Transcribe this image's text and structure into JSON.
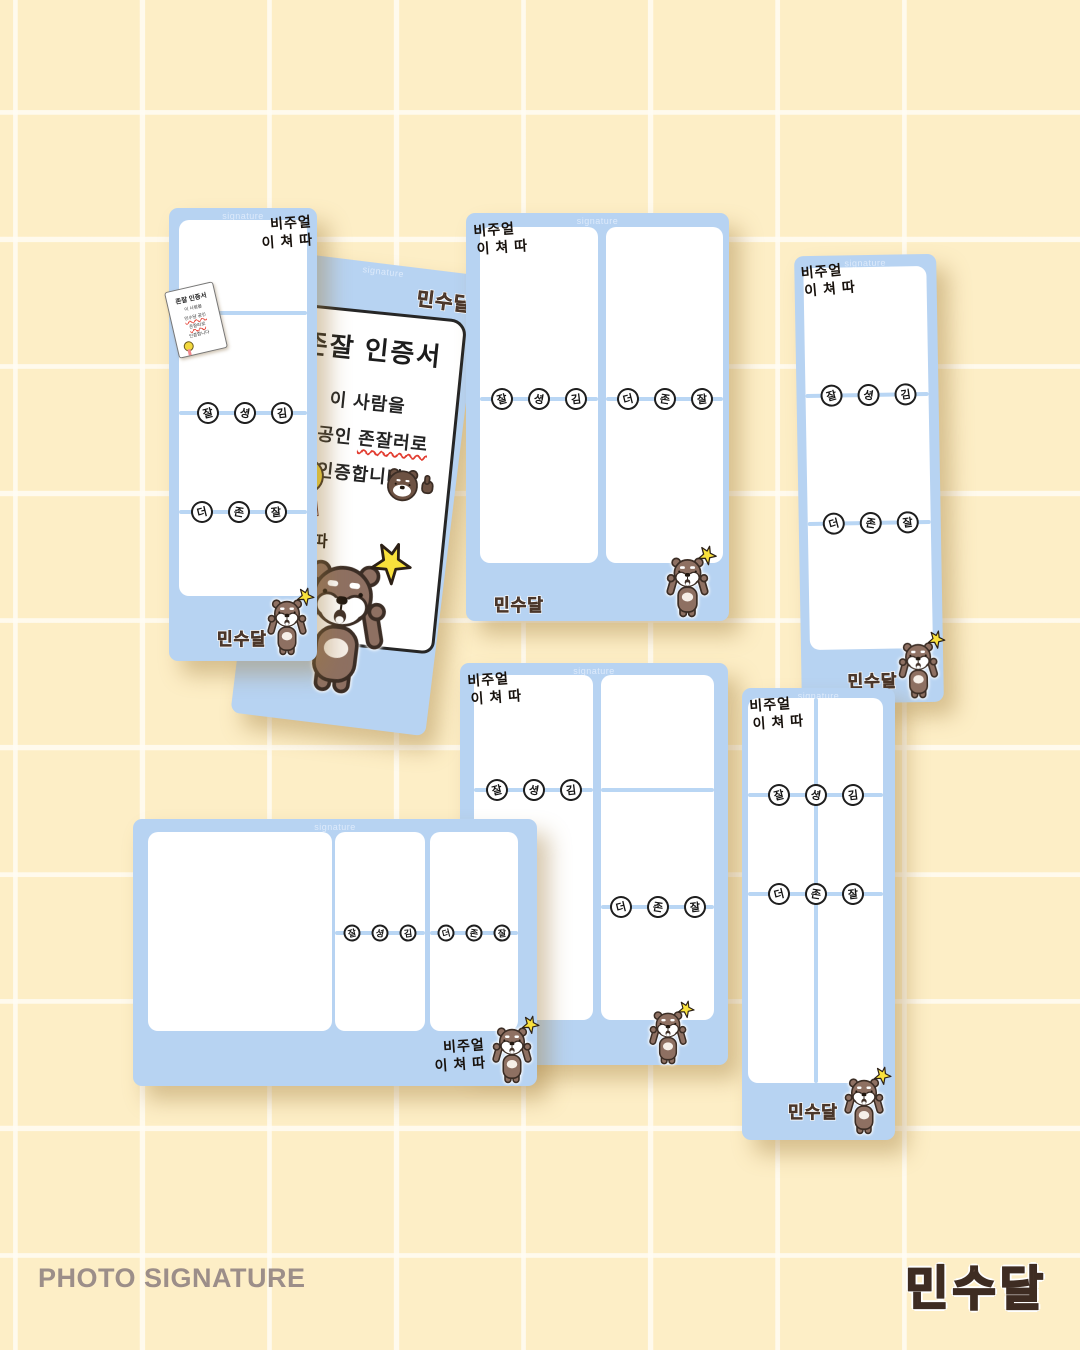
{
  "card": {
    "header": "signature",
    "visual1": "비주얼",
    "visual2": "이 쳐 따",
    "brand": "민수달",
    "row1": [
      "잘",
      "셩",
      "김"
    ],
    "row2": [
      "더",
      "존",
      "잘"
    ]
  },
  "certificate": {
    "title": "존잘 인증서",
    "line1": "이 사람을",
    "line2a": "달공인 ",
    "line2b": "존잘러로",
    "line3": "인증합니다",
    "medal": "존잘"
  },
  "note": {
    "l1": "존잘 인증서",
    "l2": "이 사람을",
    "l3": "민수달 공인",
    "l4": "존잘러로",
    "l5": "인증합니다"
  },
  "footer": {
    "title": "PHOTO SIGNATURE",
    "brand": "민수달"
  },
  "colors": {
    "background_cream": "#fdeec6",
    "grid_line": "#fffcf4",
    "card_blue": "#b7d3f2",
    "divider_blue": "#b9d6f4",
    "bear_brown": "#8e7062",
    "logo_brown": "#a07e6b",
    "accent_yellow": "#f9e13c",
    "underline_red": "#e23c30"
  }
}
